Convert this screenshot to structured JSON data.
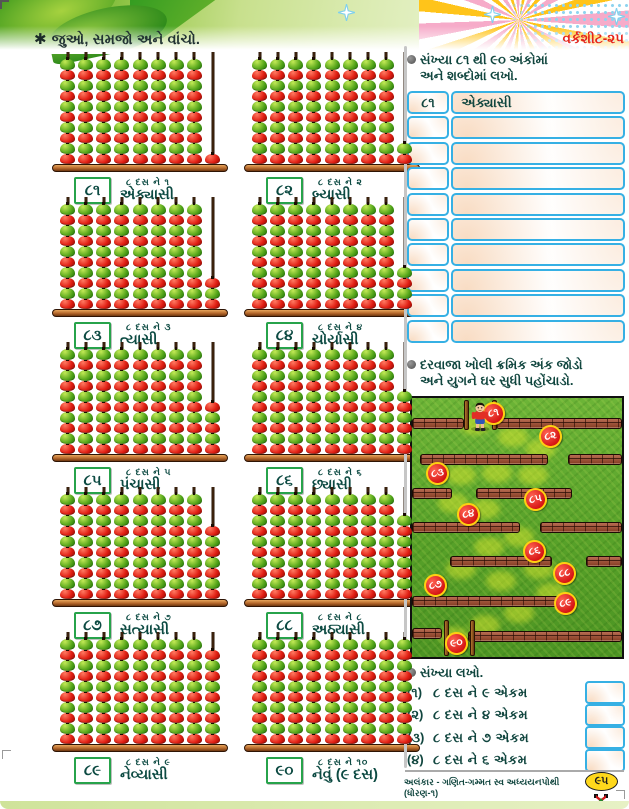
{
  "icons": {
    "asterisk": "✱",
    "bullet_note": "●"
  },
  "colors": {
    "accent_green": "#27a34b",
    "text_teal": "#11463f",
    "label_red": "#e5231b",
    "table_border_blue": "#36b0e4",
    "apple_red": "#e01d12",
    "apple_green": "#54a51a",
    "maze_circle_red": "#d61414",
    "maze_ring_yellow": "#ffd012",
    "brick": "#a84c2c",
    "page_badge_yellow": "#ffd81c"
  },
  "header": {
    "title": "જુઓ, સમજો અને વાંચો.",
    "worksheet_label": "વર્કશીટ-૨૫"
  },
  "panels": [
    {
      "numeral": "૮૧",
      "tens_text": "૮ દસ ને ૧",
      "word": "એક્યાસી",
      "tens": 8,
      "units": 1
    },
    {
      "numeral": "૮૨",
      "tens_text": "૮ દસ ને ૨",
      "word": "બ્યાસી",
      "tens": 8,
      "units": 2
    },
    {
      "numeral": "૮૩",
      "tens_text": "૮ દસ ને ૩",
      "word": "ત્યાસી",
      "tens": 8,
      "units": 3
    },
    {
      "numeral": "૮૪",
      "tens_text": "૮ દસ ને ૪",
      "word": "ચોર્યાસી",
      "tens": 8,
      "units": 4
    },
    {
      "numeral": "૮૫",
      "tens_text": "૮ દસ ને ૫",
      "word": "પંચાસી",
      "tens": 8,
      "units": 5
    },
    {
      "numeral": "૮૬",
      "tens_text": "૮ દસ ને ૬",
      "word": "છ્યાસી",
      "tens": 8,
      "units": 6
    },
    {
      "numeral": "૮૭",
      "tens_text": "૮ દસ ને ૭",
      "word": "સત્યાસી",
      "tens": 8,
      "units": 7
    },
    {
      "numeral": "૮૮",
      "tens_text": "૮ દસ ને ૮",
      "word": "અઠ્યાસી",
      "tens": 8,
      "units": 8
    },
    {
      "numeral": "૮૯",
      "tens_text": "૮ દસ ને ૯",
      "word": "નેવ્યાસી",
      "tens": 8,
      "units": 9
    },
    {
      "numeral": "૯૦",
      "tens_text": "૮ દસ ને ૧૦",
      "word": "નેવું (૯ દસ)",
      "tens": 8,
      "units": 10
    }
  ],
  "write_words": {
    "prompt_line1": "સંખ્યા ૮૧ થી ૯૦ અંકોમાં",
    "prompt_line2": "અને શબ્દોમાં લખો.",
    "rows": [
      {
        "number": "૮૧",
        "word": "એક્યાસી",
        "filled": true
      },
      {
        "number": "",
        "word": "",
        "filled": false
      },
      {
        "number": "",
        "word": "",
        "filled": false
      },
      {
        "number": "",
        "word": "",
        "filled": false
      },
      {
        "number": "",
        "word": "",
        "filled": false
      },
      {
        "number": "",
        "word": "",
        "filled": false
      },
      {
        "number": "",
        "word": "",
        "filled": false
      },
      {
        "number": "",
        "word": "",
        "filled": false
      },
      {
        "number": "",
        "word": "",
        "filled": false
      },
      {
        "number": "",
        "word": "",
        "filled": false
      }
    ]
  },
  "maze": {
    "prompt_line1": "દરવાજા ખોલી ક્રમિક અંક જોડો",
    "prompt_line2": "અને યુગને ઘર સુધી પહોંચાડો.",
    "nodes": [
      {
        "label": "૮૧",
        "x": 81,
        "y": 15
      },
      {
        "label": "૮૨",
        "x": 138,
        "y": 38
      },
      {
        "label": "૮૩",
        "x": 25,
        "y": 75
      },
      {
        "label": "૮૫",
        "x": 123,
        "y": 101
      },
      {
        "label": "૮૪",
        "x": 56,
        "y": 116
      },
      {
        "label": "૮૬",
        "x": 122,
        "y": 153
      },
      {
        "label": "૮૮",
        "x": 152,
        "y": 175
      },
      {
        "label": "૮૭",
        "x": 23,
        "y": 187
      },
      {
        "label": "૮૯",
        "x": 153,
        "y": 205
      },
      {
        "label": "૯૦",
        "x": 44,
        "y": 245
      }
    ]
  },
  "write_numbers": {
    "prompt": "સંખ્યા લખો.",
    "items": [
      {
        "index": "(૧)",
        "text": "૮ દસ ને ૯ એકમ"
      },
      {
        "index": "(૨)",
        "text": "૮ દસ ને ૪ એકમ"
      },
      {
        "index": "(૩)",
        "text": "૮ દસ ને ૭ એકમ"
      },
      {
        "index": "(૪)",
        "text": "૮ દસ ને ૬ એકમ"
      }
    ]
  },
  "footer": {
    "text": "અલંકાર - ગણિત-ગમ્મત સ્વ અધ્યયનપોથી (ધોરણ-૧)",
    "page_number": "૯૫"
  }
}
